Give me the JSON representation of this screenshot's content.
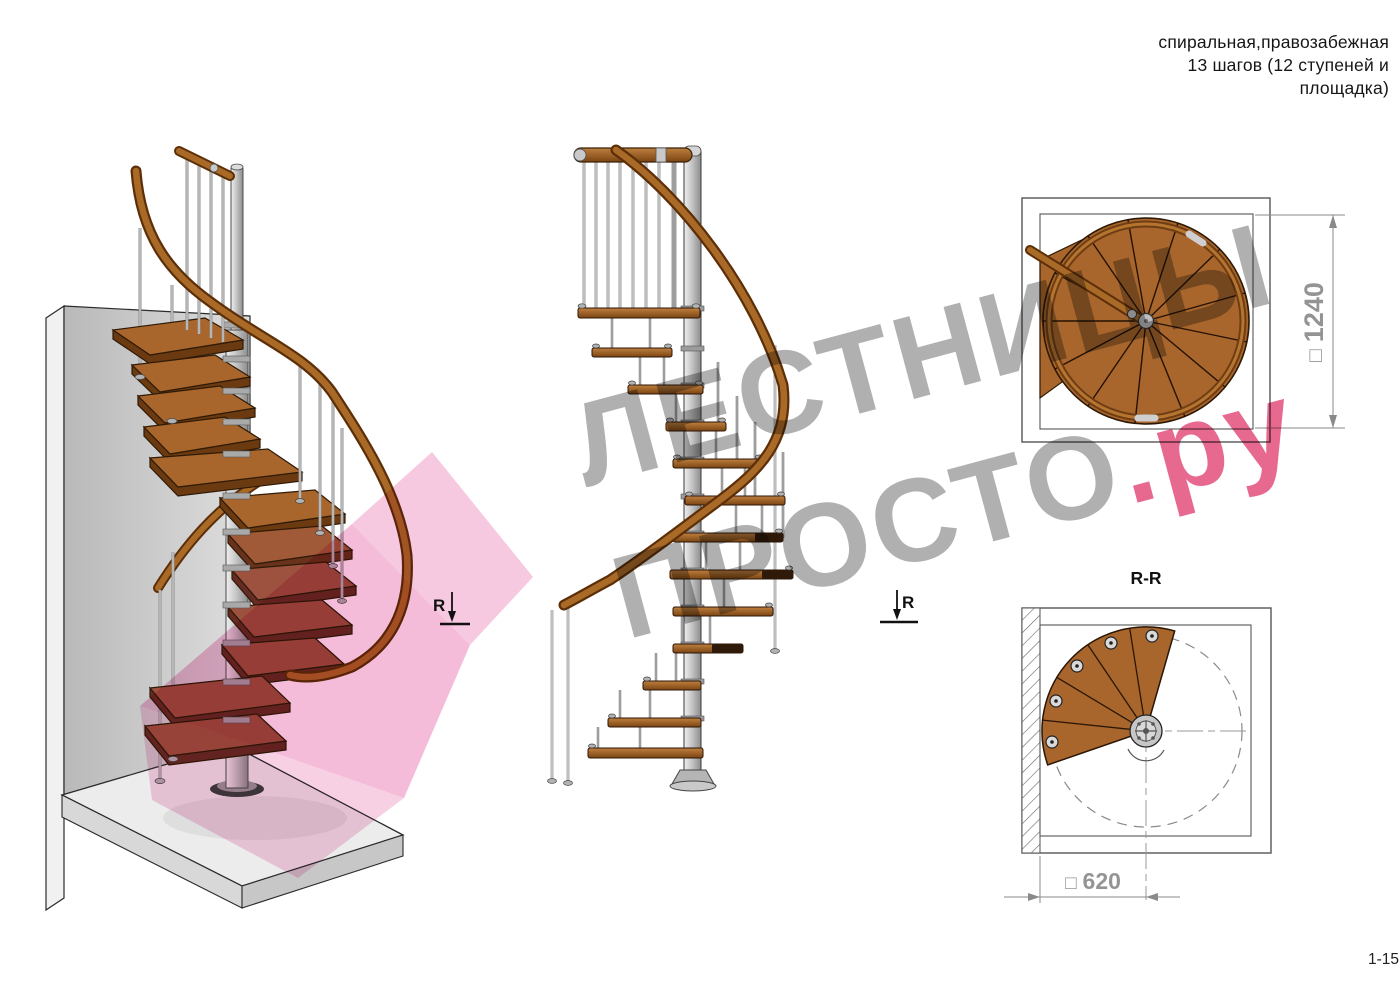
{
  "header": {
    "lines": [
      "спиральная,правозабежная",
      "13 шагов (12 ступеней и",
      "площадка)"
    ]
  },
  "watermark": {
    "line1": "ЛЕСТНИЦЫ",
    "line2": "ПРОСТО",
    "line2_suffix": ".ру"
  },
  "plan_view": {
    "dim_prefix": "□",
    "dim_value": "1240"
  },
  "section_view": {
    "title": "R-R",
    "dim_prefix": "□",
    "dim_value": "620"
  },
  "section_markers": {
    "left_label": "R",
    "right_label": "R"
  },
  "page_number": "1-15",
  "colors": {
    "watermark_gray": "#b0b0b0",
    "watermark_pink": "#e8698f",
    "overlay_pink": "#f4bcd9",
    "wood": "#a9662c",
    "wood_dark": "#6e3d12",
    "metal": "#c9c9c9",
    "dim_gray": "#949494"
  }
}
